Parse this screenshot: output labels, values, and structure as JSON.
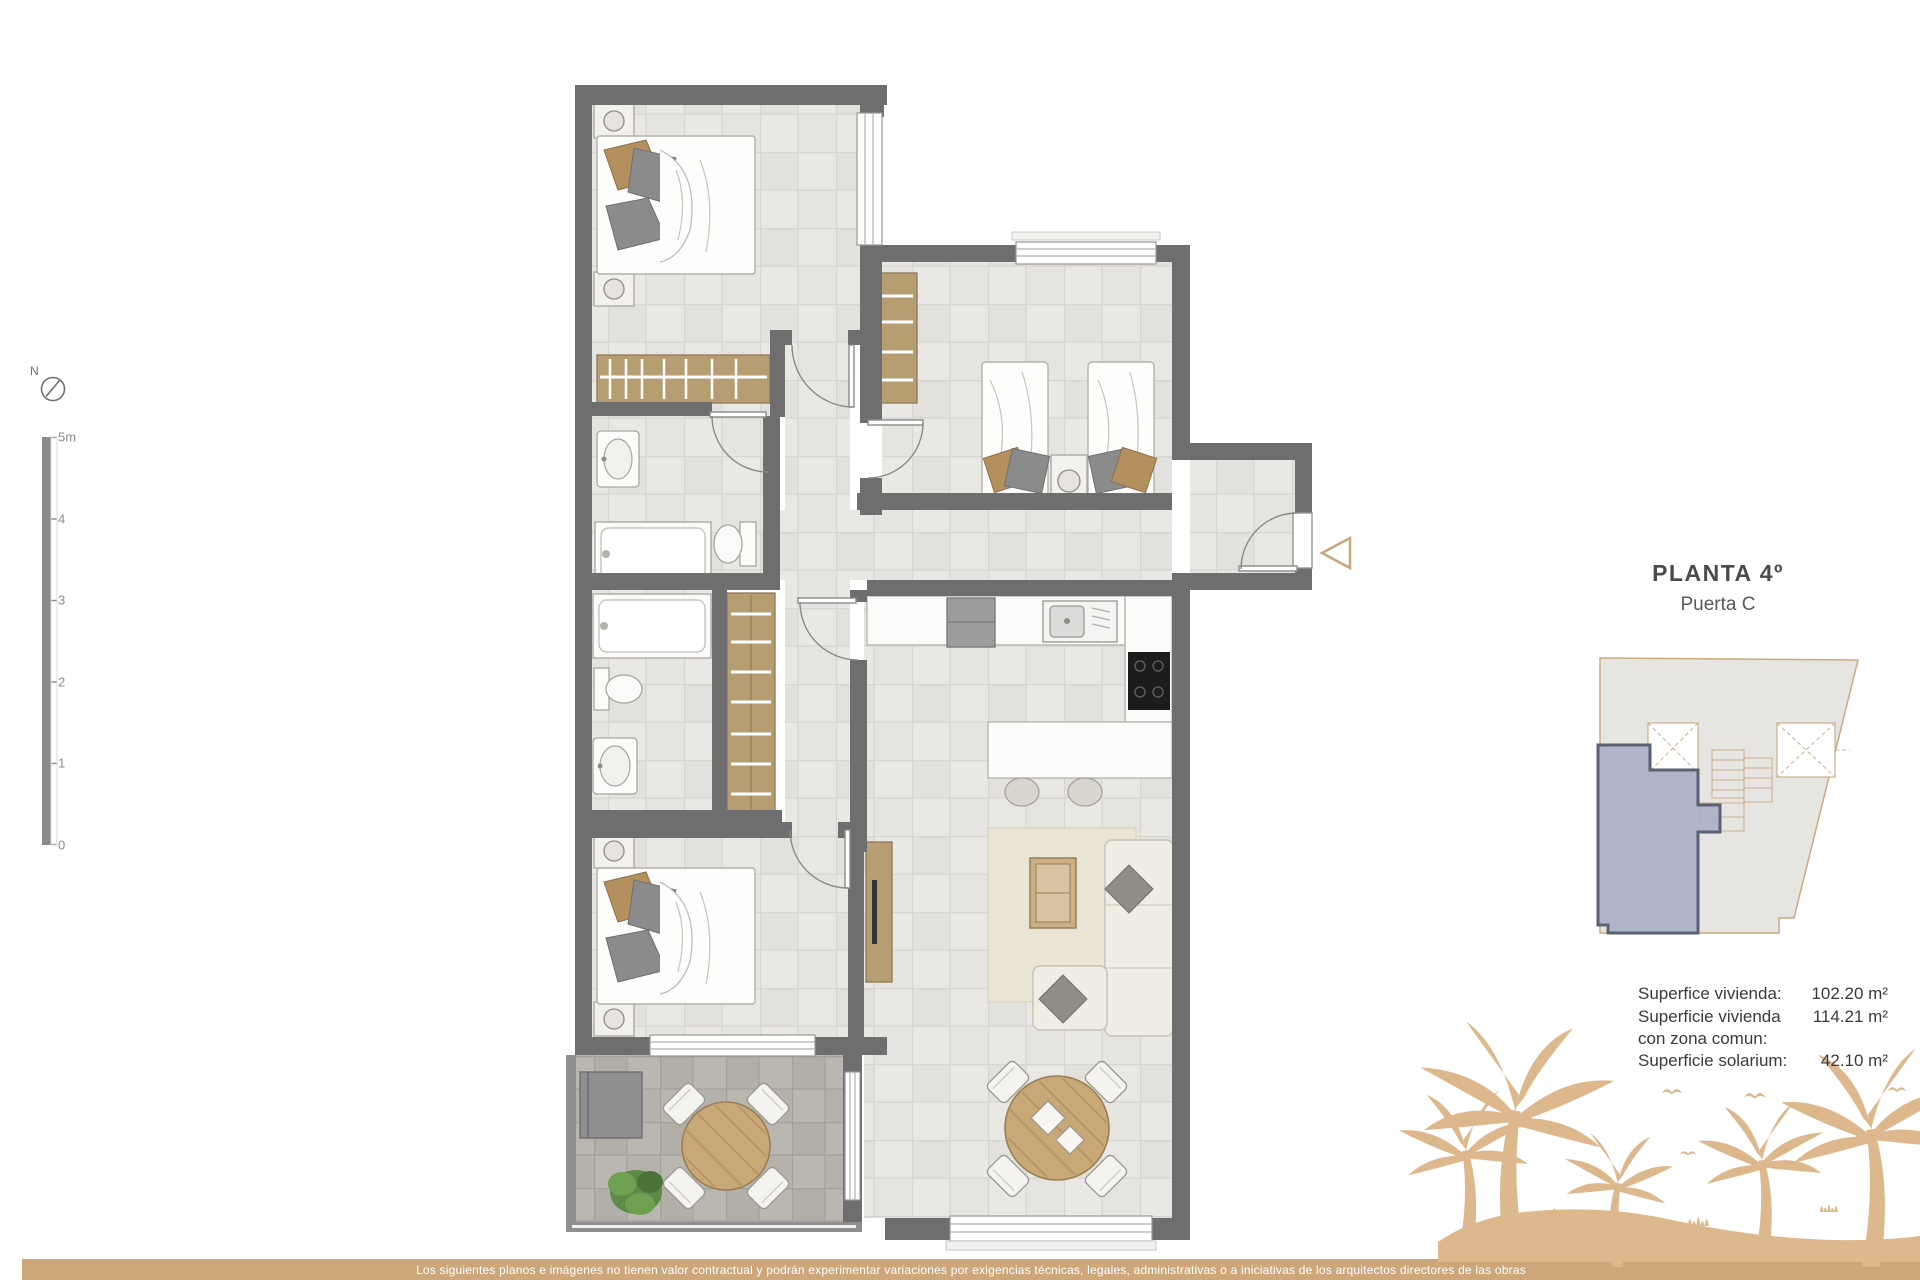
{
  "page": {
    "title": "PLANTA 4º",
    "subtitle": "Puerta C",
    "compass_label": "N",
    "scale_labels": [
      "5m",
      "4",
      "3",
      "2",
      "1",
      "0"
    ],
    "areas": [
      {
        "label": "Superfice vivienda:",
        "value": "102.20 m²"
      },
      {
        "label": "Superficie vivienda con zona comun:",
        "value": "114.21 m²"
      },
      {
        "label": "Superficie solarium:",
        "value": "42.10 m²"
      }
    ],
    "footer_disclaimer": "Los siguientes planos e imágenes no tienen valor contractual y podrán experimentar variaciones por exigencias técnicas, legales, administrativas o a iniciativas de los arquitectos directores de las obras",
    "colors": {
      "wall": "#6e6e6e",
      "wood": "#b79d72",
      "table_wood": "#c8a876",
      "footer_bar": "#cda67a",
      "palm_silhouette": "#ddb88c",
      "unit_highlight": "#a9b1c8",
      "unit_border": "#5a6173",
      "keyplan_outline": "#c9ab80"
    }
  }
}
